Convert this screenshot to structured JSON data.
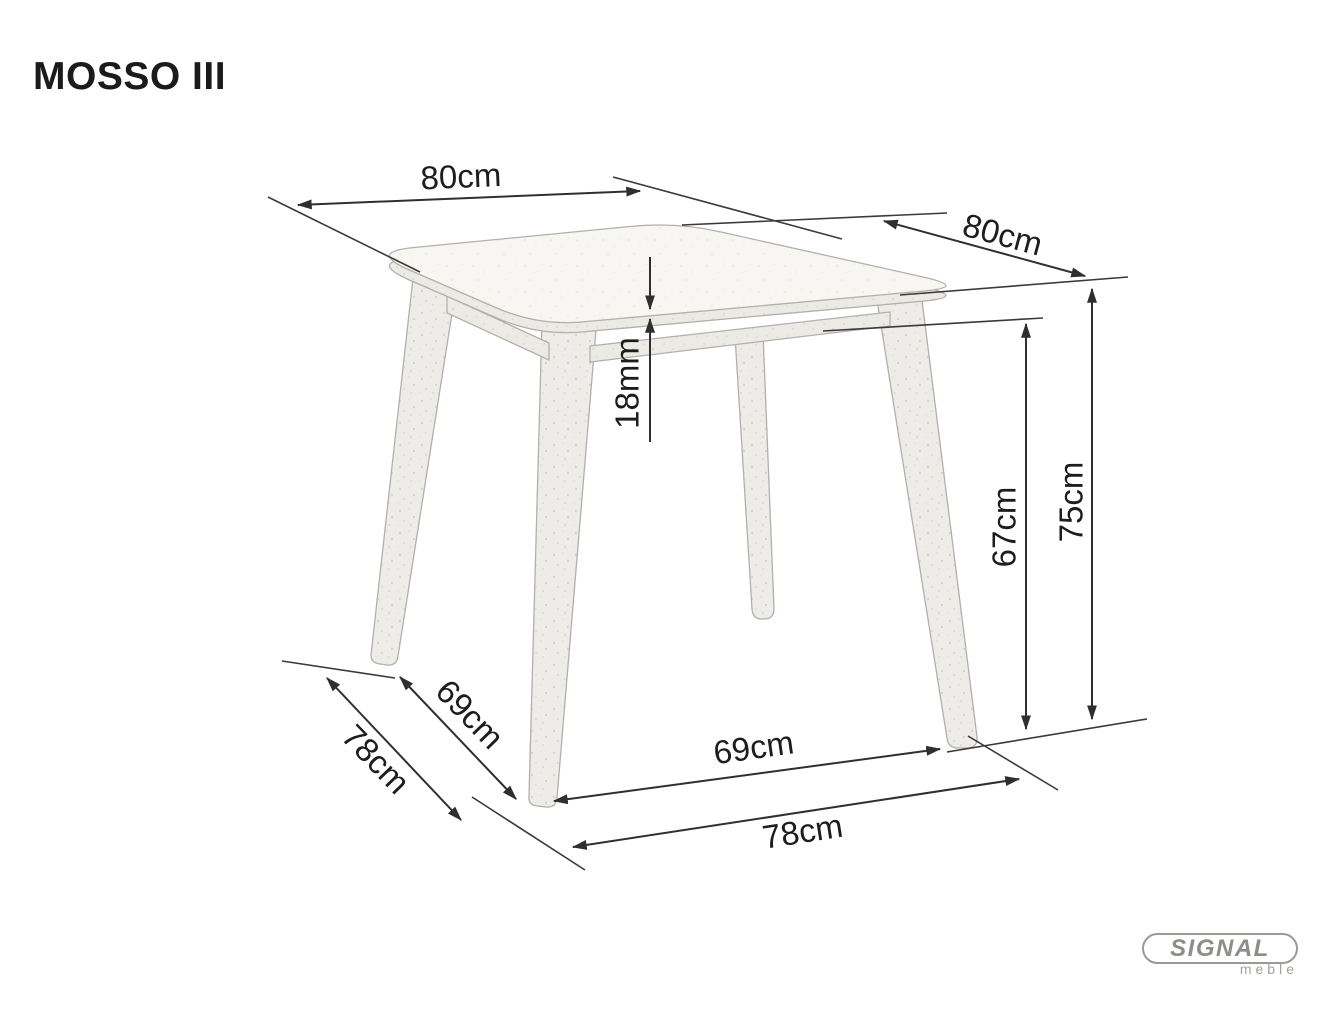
{
  "title": "MOSSO III",
  "dimensions": {
    "top_width_left": "80cm",
    "top_width_right": "80cm",
    "top_thickness": "18mm",
    "underframe_height": "67cm",
    "total_height": "75cm",
    "side_leg_span": "69cm",
    "side_total_depth": "78cm",
    "front_leg_span": "69cm",
    "front_total_width": "78cm"
  },
  "brand": {
    "name": "SIGNAL",
    "subtitle": "meble"
  },
  "colors": {
    "dimension_line": "#2f2f2f",
    "label_text": "#1d1d1d",
    "furniture_stroke": "#b2b0aa",
    "furniture_fill": "#f7f6f2",
    "logo_gray": "#8f8d89",
    "background": "#ffffff"
  }
}
